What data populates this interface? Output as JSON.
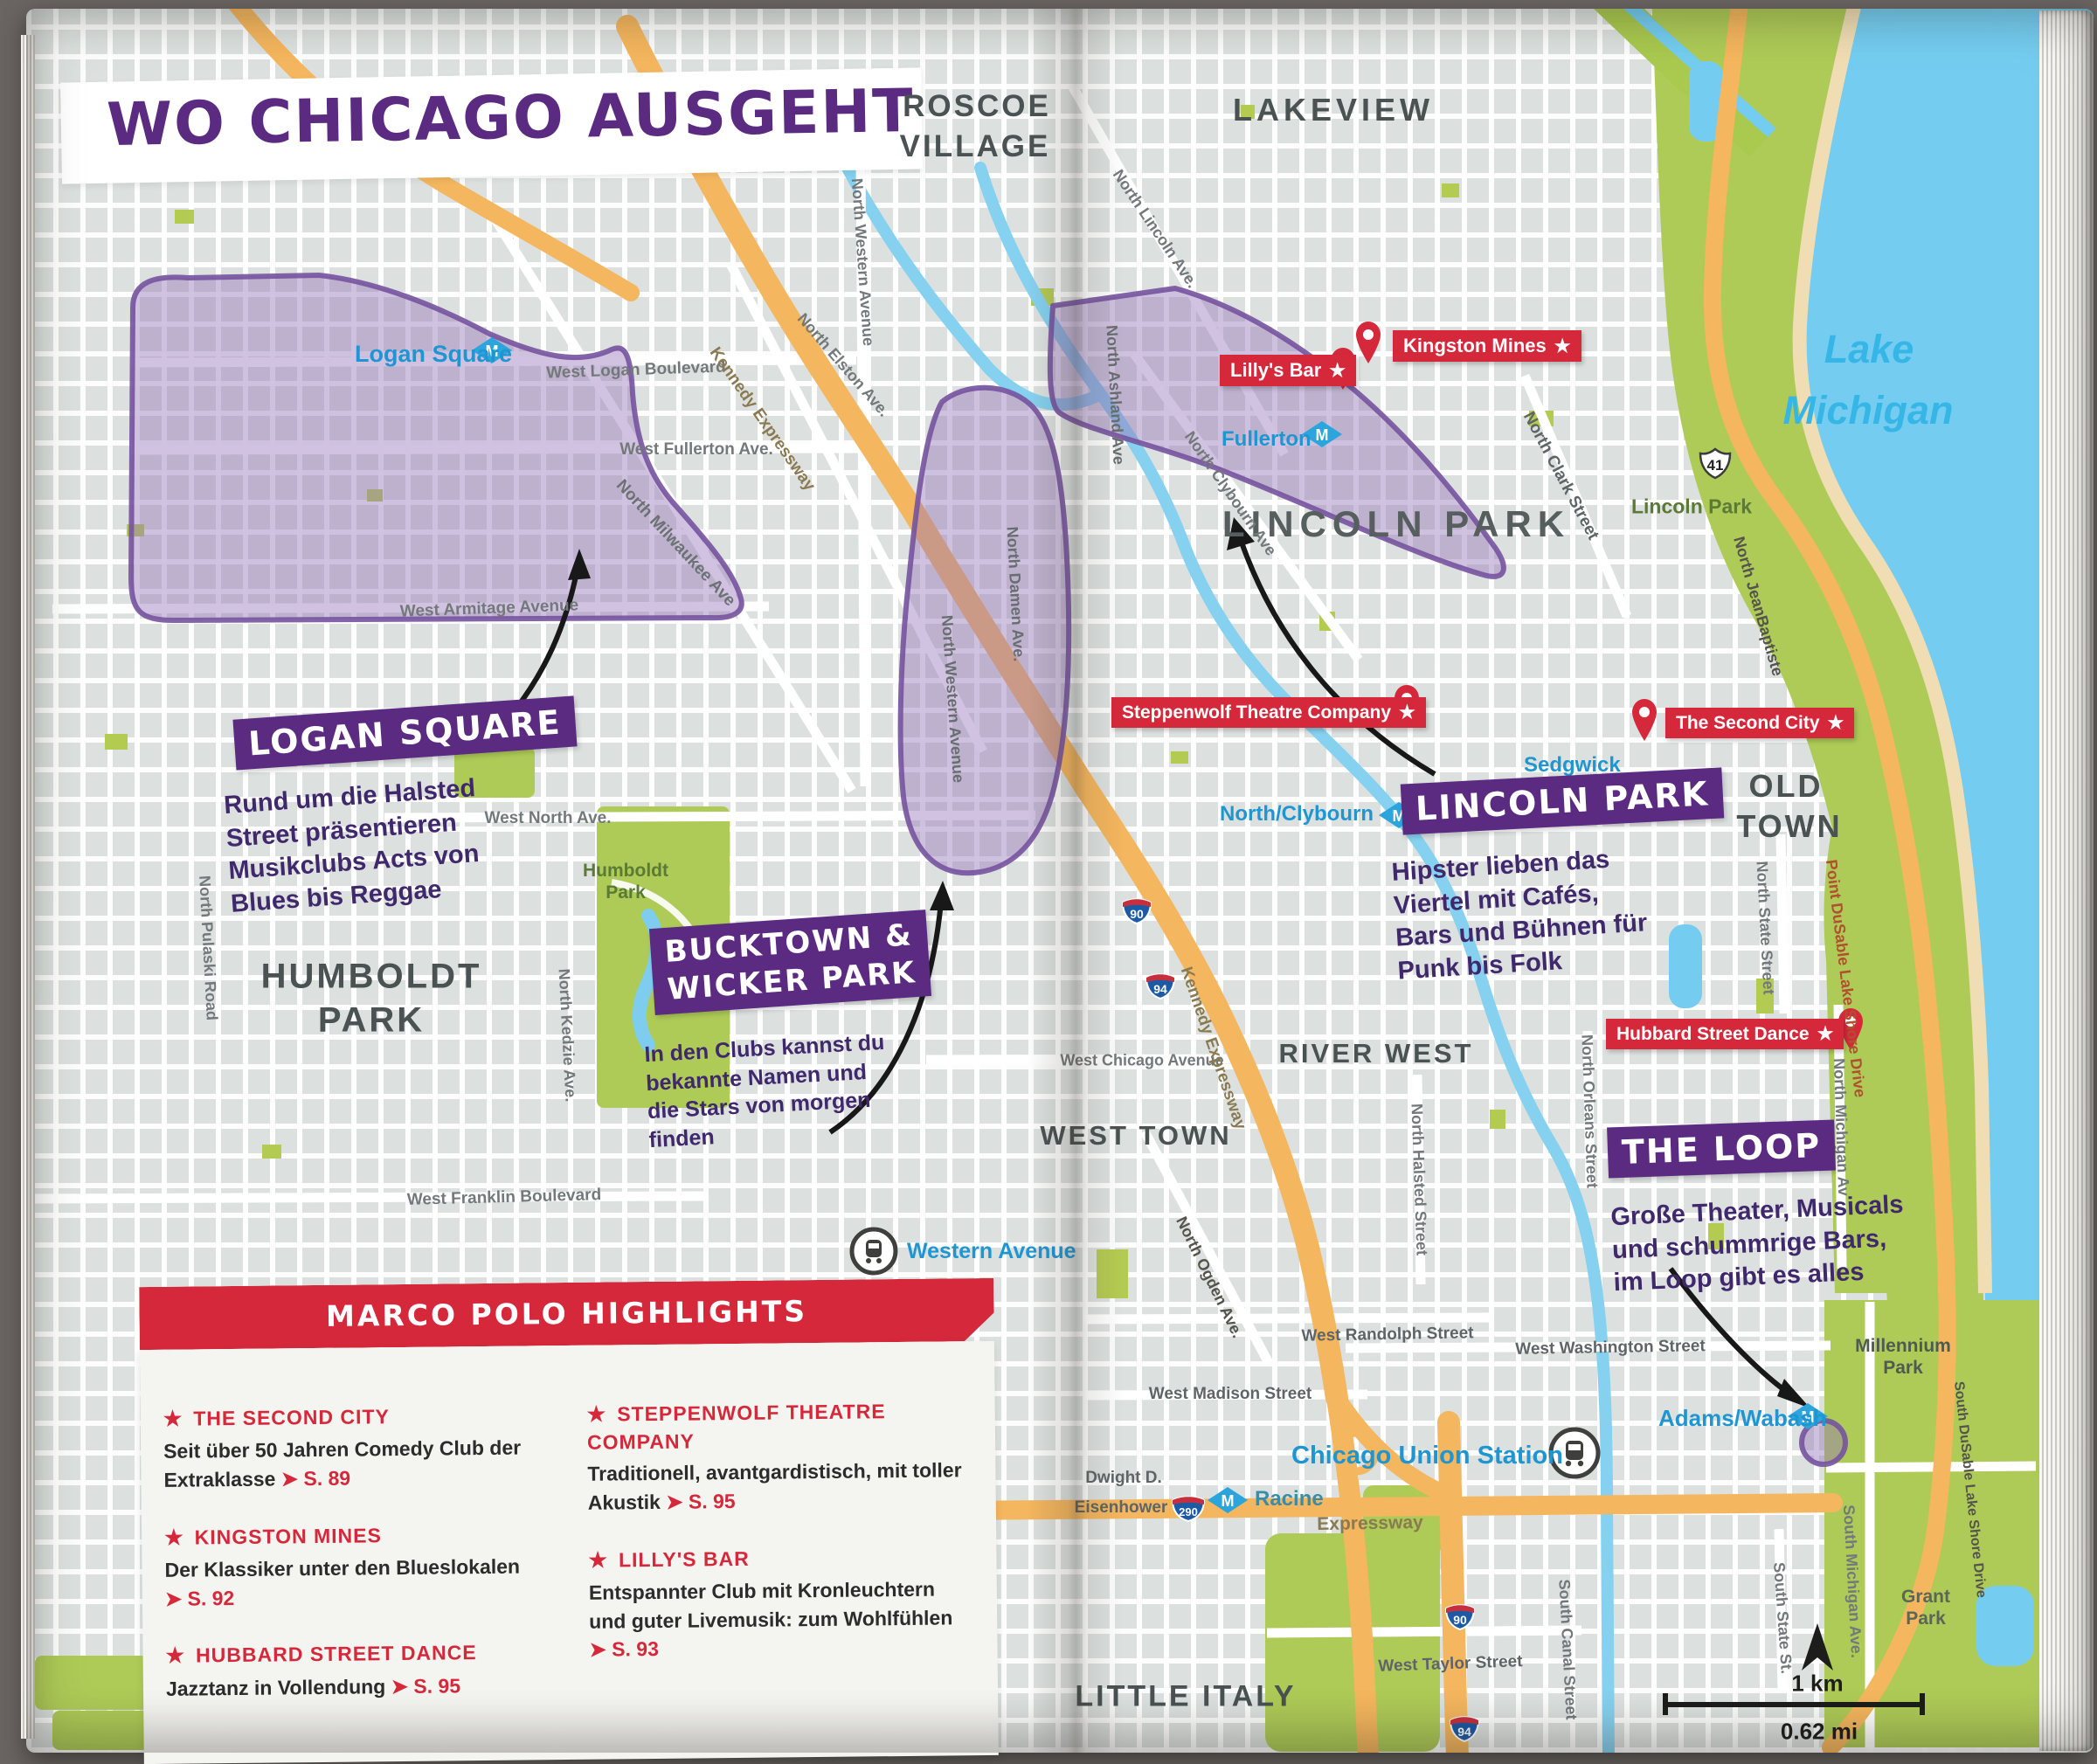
{
  "icons": {
    "star": "★",
    "metro_m": "M",
    "page_arrow": "➤"
  },
  "title": {
    "text": "WO CHICAGO AUSGEHT"
  },
  "scale": {
    "km": "1 km",
    "mi": "0.62 mi"
  },
  "water": {
    "lake1": "Lake",
    "lake2": "Michigan"
  },
  "neighborhoods": {
    "roscoe1": "ROSCOE",
    "roscoe2": "VILLAGE",
    "lakeview": "LAKEVIEW",
    "lincoln_park": "LINCOLN PARK",
    "old1": "OLD",
    "old2": "TOWN",
    "humboldt1": "HUMBOLDT",
    "humboldt2": "PARK",
    "river_west": "RIVER WEST",
    "west_town": "WEST TOWN",
    "little_italy": "LITTLE ITALY"
  },
  "parks": {
    "humboldt1": "Humboldt",
    "humboldt2": "Park",
    "lincoln": "Lincoln Park",
    "millennium1": "Millennium",
    "millennium2": "Park",
    "grant1": "Grant",
    "grant2": "Park"
  },
  "districts": {
    "logan": {
      "label": "LOGAN SQUARE",
      "desc": [
        "Rund um die Halsted",
        "Street präsentieren",
        "Musikclubs Acts von",
        "Blues bis Reggae"
      ]
    },
    "bucktown": {
      "label": [
        "BUCKTOWN &",
        "WICKER PARK"
      ],
      "desc": [
        "In den Clubs kannst du",
        "bekannte Namen und",
        "die Stars von morgen",
        "finden"
      ]
    },
    "lincoln": {
      "label": "LINCOLN PARK",
      "desc": [
        "Hipster lieben das",
        "Viertel mit Cafés,",
        "Bars und Bühnen für",
        "Punk bis Folk"
      ]
    },
    "loop": {
      "label": "THE LOOP",
      "desc": [
        "Große Theater, Musicals",
        "und schummrige Bars,",
        "im Loop gibt es alles"
      ]
    }
  },
  "pois": {
    "lillys": "Lilly's Bar",
    "kingston": "Kingston Mines",
    "steppenwolf": "Steppenwolf Theatre Company",
    "second_city": "The Second City",
    "hubbard": "Hubbard Street Dance"
  },
  "metro": {
    "logan_square": "Logan Square",
    "fullerton": "Fullerton",
    "north_clybourn": "North/Clybourn",
    "sedgwick": "Sedgwick",
    "adams_wabash": "Adams/Wabash",
    "racine": "Racine"
  },
  "rail": {
    "western": "Western Avenue",
    "union": "Chicago Union Station"
  },
  "highways": {
    "i90": "90",
    "i94": "94",
    "i290": "290",
    "us41": "41"
  },
  "streets": [
    "West Logan Boulevard",
    "West Fullerton Ave.",
    "North Milwaukee Ave",
    "West Armitage Avenue",
    "North Western Avenue",
    "North Elston Ave.",
    "Kennedy Expressway",
    "North Lincoln Ave.",
    "North Ashland Ave",
    "North Clybourn Ave",
    "North Clark Street",
    "North JeanBaptiste",
    "Point DuSable Lake Shore Drive",
    "North State Street",
    "North Pulaski Road",
    "North Kedzie Ave.",
    "West North Ave.",
    "West Franklin Boulevard",
    "West Chicago Avenue",
    "Kennedy Expressway",
    "North Ogden Ave.",
    "North Halsted Street",
    "North Orleans Street",
    "North Michigan Av",
    "West Randolph Street",
    "West Washington Street",
    "West Madison Street",
    "West Taylor Street",
    "South Canal Street",
    "South State St.",
    "South Michigan Ave.",
    "South DuSable Lake Shore Drive",
    "Dwight D.",
    "Eisenhower",
    "Expressway",
    "North Damen Ave.",
    "North Western Avenue"
  ],
  "highlights": {
    "title": "MARCO POLO HIGHLIGHTS",
    "entries": [
      {
        "name": "THE SECOND CITY",
        "body": "Seit über 50 Jahren Comedy Club der Extraklasse",
        "page": "➤ S. 89"
      },
      {
        "name": "KINGSTON MINES",
        "body": "Der Klassiker unter den Blueslokalen",
        "page": "➤ S. 92"
      },
      {
        "name": "HUBBARD STREET DANCE",
        "body": "Jazztanz in Vollendung",
        "page": "➤ S. 95"
      },
      {
        "name": "STEPPENWOLF THEATRE COMPANY",
        "body": "Traditionell, avantgardistisch, mit toller Akustik",
        "page": "➤ S. 95"
      },
      {
        "name": "LILLY'S BAR",
        "body": "Entspannter Club mit Kronleuchtern und guter Livemusik: zum Wohlfühlen",
        "page": "➤ S. 93"
      }
    ]
  }
}
